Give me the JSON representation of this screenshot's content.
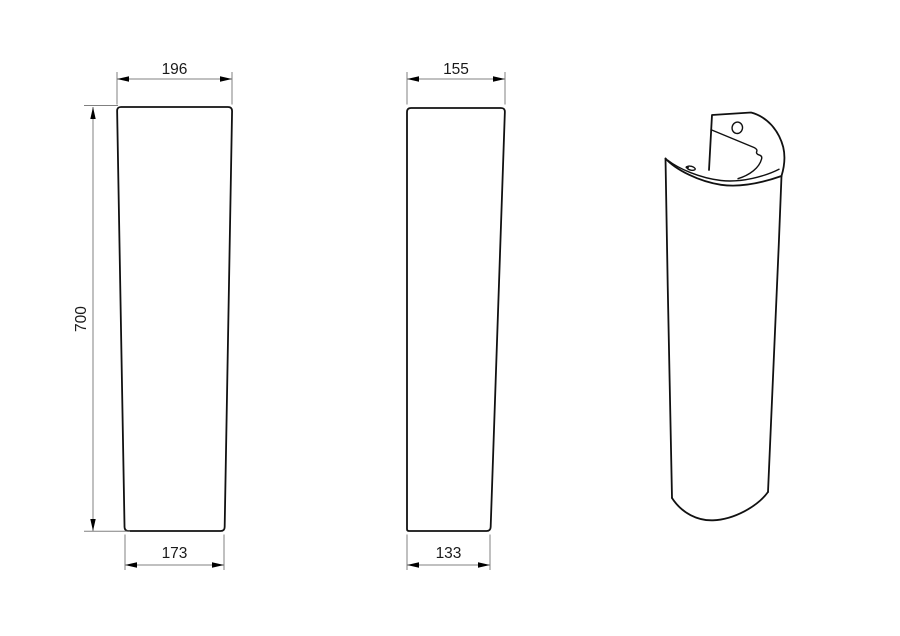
{
  "canvas": {
    "width": 900,
    "height": 636,
    "background": "#ffffff"
  },
  "colors": {
    "outline": "#111111",
    "dimension_line": "#808080",
    "arrowhead": "#000000",
    "label_text": "#1a1a1a"
  },
  "dimensions": {
    "front_top_width": "196",
    "front_bottom_width": "173",
    "front_height": "700",
    "side_top_width": "155",
    "side_bottom_width": "133"
  }
}
